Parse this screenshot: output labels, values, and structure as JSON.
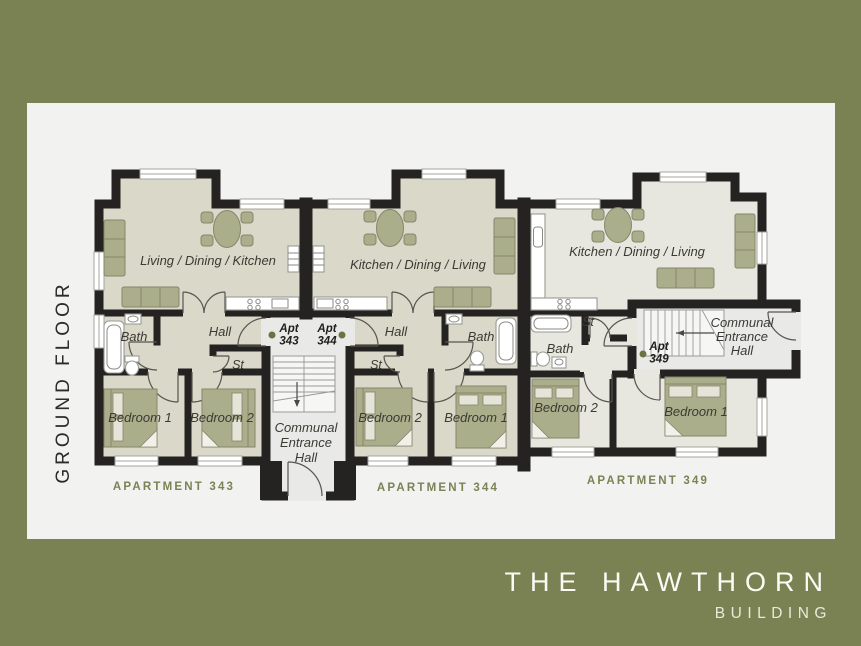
{
  "floor_label": "GROUND FLOOR",
  "brand": {
    "name": "THE HAWTHORN",
    "building": "BUILDING"
  },
  "apartments": {
    "apt343": {
      "footer": "APARTMENT 343",
      "living": "Living / Dining / Kitchen",
      "bath": "Bath",
      "hall": "Hall",
      "store": "St",
      "bedroom1": "Bedroom 1",
      "bedroom2": "Bedroom 2",
      "tag": {
        "line1": "Apt",
        "line2": "343"
      }
    },
    "apt344": {
      "footer": "APARTMENT 344",
      "living": "Kitchen / Dining / Living",
      "bath": "Bath",
      "hall": "Hall",
      "store": "St",
      "bedroom1": "Bedroom 1",
      "bedroom2": "Bedroom 2",
      "tag": {
        "line1": "Apt",
        "line2": "344"
      }
    },
    "apt349": {
      "footer": "APARTMENT 349",
      "living": "Kitchen / Dining / Living",
      "bath": "Bath",
      "store": "St",
      "bedroom1": "Bedroom 1",
      "bedroom2": "Bedroom 2",
      "tag": {
        "line1": "Apt",
        "line2": "349"
      }
    }
  },
  "communal": {
    "middle": {
      "lines": [
        "Communal",
        "Entrance",
        "Hall"
      ]
    },
    "right": {
      "lines": [
        "Communal",
        "Entrance",
        "Hall"
      ]
    }
  },
  "colors": {
    "bg": "#7a8152",
    "panel": "#f2f2f1",
    "wall": "#242321",
    "room": "#d9d8c9",
    "room_alt": "#e7e6df",
    "communal": "#e9e9e7",
    "furniture": "#abae8b",
    "accent": "#7c8254",
    "dot": "#6d7243",
    "title_text": "#fbfbf4",
    "subtitle_text": "#e9ead9"
  }
}
